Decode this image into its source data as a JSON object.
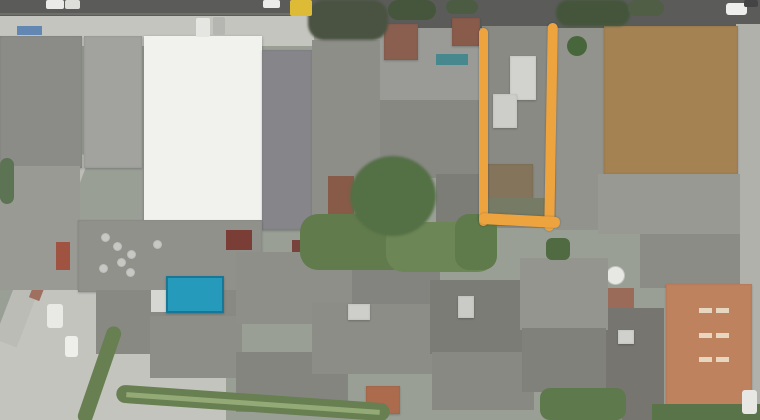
{
  "image": {
    "width": 760,
    "height": 420
  },
  "annotation": {
    "shape": "open-rectangle-outline",
    "color": "#f3a437"
  },
  "scene": {
    "base_color": "#9aa096",
    "palette": {
      "road": "#5a5b58",
      "concrete": "#c6c6c1",
      "roof_grey": "#8e8e89",
      "warehouse_white": "#f3f3f0",
      "dirt_lot": "#a7824e",
      "terracotta": "#c4815a",
      "pool_blue": "#1e9cc0",
      "vegetation": "#5f7b49",
      "annotation_orange": "#f3a437"
    },
    "elements": [
      {
        "name": "road-top",
        "x": 0,
        "y": 0,
        "w": 760,
        "h": 30,
        "color": "#5a5b58"
      },
      {
        "name": "road-lane-line",
        "x": 0,
        "y": 13,
        "w": 310,
        "h": 2,
        "color": "#6e6e6a"
      },
      {
        "name": "sidewalk-top-left",
        "x": 0,
        "y": 16,
        "w": 314,
        "h": 30,
        "color": "#c6c6c1",
        "cls": "mottle"
      },
      {
        "name": "street-right-edge",
        "x": 736,
        "y": 24,
        "w": 24,
        "h": 396,
        "color": "#b2b2ac",
        "cls": "mottle"
      },
      {
        "name": "plaza-bottom-left",
        "x": 0,
        "y": 284,
        "w": 226,
        "h": 136,
        "color": "#c5c5c0",
        "cls": "mottle",
        "clip": "polygon(14% 0,48% 0,100% 62%,100% 100%,0 100%,0 32%)"
      },
      {
        "name": "street-diagonal-left",
        "x": 30,
        "y": 146,
        "w": 24,
        "h": 204,
        "color": "#bdbdb7",
        "rz": 21
      },
      {
        "name": "brick-path-diagonal",
        "x": 44,
        "y": 216,
        "w": 11,
        "h": 86,
        "color": "#a26e5e",
        "rz": 21
      },
      {
        "name": "building-block-left",
        "x": 0,
        "y": 36,
        "w": 82,
        "h": 132,
        "color": "#8b8b87",
        "cls": "mottle b"
      },
      {
        "name": "building-block-left-lower",
        "x": 0,
        "y": 166,
        "w": 80,
        "h": 124,
        "color": "#9b9b95",
        "cls": "mottle"
      },
      {
        "name": "red-patch-left",
        "x": 56,
        "y": 242,
        "w": 14,
        "h": 28,
        "color": "#a5513c"
      },
      {
        "name": "ribbed-factory-roof",
        "x": 84,
        "y": 36,
        "w": 58,
        "h": 132,
        "color": "#a3a39f",
        "cls": "ribs b"
      },
      {
        "name": "white-warehouse-roof",
        "x": 144,
        "y": 36,
        "w": 118,
        "h": 186,
        "color": "#f3f3f0",
        "cls": "seam"
      },
      {
        "name": "building-block-b",
        "x": 262,
        "y": 50,
        "w": 50,
        "h": 180,
        "color": "#85858a",
        "cls": "mottle b"
      },
      {
        "name": "building-block-c",
        "x": 312,
        "y": 40,
        "w": 68,
        "h": 192,
        "color": "#8e8e89",
        "cls": "mottle"
      },
      {
        "name": "building-block-d",
        "x": 380,
        "y": 28,
        "w": 102,
        "h": 74,
        "color": "#9b9b96",
        "cls": "mottle"
      },
      {
        "name": "building-block-d2",
        "x": 380,
        "y": 100,
        "w": 102,
        "h": 78,
        "color": "#888883",
        "cls": "mottle"
      },
      {
        "name": "building-block-d3",
        "x": 436,
        "y": 174,
        "w": 46,
        "h": 58,
        "color": "#7d7d78",
        "cls": "mottle"
      },
      {
        "name": "brown-roof-a",
        "x": 384,
        "y": 24,
        "w": 34,
        "h": 36,
        "color": "#8c5e4e",
        "cls": "b"
      },
      {
        "name": "brown-roof-b",
        "x": 452,
        "y": 18,
        "w": 28,
        "h": 28,
        "color": "#8c5a48",
        "cls": "b"
      },
      {
        "name": "teal-roof-strip",
        "x": 436,
        "y": 54,
        "w": 32,
        "h": 11,
        "color": "#41898f"
      },
      {
        "name": "rust-roof-mid",
        "x": 328,
        "y": 176,
        "w": 26,
        "h": 48,
        "color": "#8a5a44"
      },
      {
        "name": "marked-lot-ground",
        "x": 482,
        "y": 26,
        "w": 74,
        "h": 202,
        "color": "#8a8a84",
        "cls": "mottle"
      },
      {
        "name": "marked-lot-building-a",
        "x": 510,
        "y": 56,
        "w": 26,
        "h": 44,
        "color": "#d4d4d0",
        "cls": "b"
      },
      {
        "name": "marked-lot-building-b",
        "x": 493,
        "y": 94,
        "w": 24,
        "h": 34,
        "color": "#cfcfcb",
        "cls": "b"
      },
      {
        "name": "marked-lot-shed",
        "x": 487,
        "y": 164,
        "w": 46,
        "h": 42,
        "color": "#85745a",
        "cls": "b"
      },
      {
        "name": "marked-lot-yard",
        "x": 484,
        "y": 198,
        "w": 70,
        "h": 28,
        "color": "#767b63",
        "cls": "leaf"
      },
      {
        "name": "building-block-e",
        "x": 556,
        "y": 28,
        "w": 50,
        "h": 202,
        "color": "#93938d",
        "cls": "mottle"
      },
      {
        "name": "round-bush",
        "x": 567,
        "y": 36,
        "w": 20,
        "h": 20,
        "color": "#466637",
        "r": "50%",
        "cls": "leaf"
      },
      {
        "name": "dirt-lot",
        "x": 604,
        "y": 26,
        "w": 134,
        "h": 148,
        "color": "#a7824e",
        "cls": "dirtm b"
      },
      {
        "name": "building-block-f",
        "x": 598,
        "y": 174,
        "w": 142,
        "h": 60,
        "color": "#9a9a94",
        "cls": "mottle"
      },
      {
        "name": "building-block-f2",
        "x": 640,
        "y": 234,
        "w": 100,
        "h": 54,
        "color": "#8c8c86",
        "cls": "mottle"
      },
      {
        "name": "brick-patch-right",
        "x": 604,
        "y": 288,
        "w": 30,
        "h": 24,
        "color": "#9c6a55"
      },
      {
        "name": "building-block-g",
        "x": 598,
        "y": 308,
        "w": 66,
        "h": 112,
        "color": "#76756e",
        "cls": "speck"
      },
      {
        "name": "terracotta-roof",
        "x": 666,
        "y": 284,
        "w": 86,
        "h": 126,
        "color": "#c4815a",
        "cls": "tile b"
      },
      {
        "name": "water-tank",
        "x": 607,
        "y": 267,
        "w": 17,
        "h": 17,
        "color": "#e9e9e5",
        "r": "50%",
        "cls": "vent"
      },
      {
        "name": "roof-mid-left",
        "x": 78,
        "y": 220,
        "w": 184,
        "h": 72,
        "color": "#91918b",
        "cls": "corrug b"
      },
      {
        "name": "roof-vent",
        "x": 102,
        "y": 234,
        "w": 7,
        "h": 7,
        "color": "#c8c8c4",
        "r": "50%",
        "cls": "vent"
      },
      {
        "name": "roof-vent",
        "x": 114,
        "y": 243,
        "w": 7,
        "h": 7,
        "color": "#c8c8c4",
        "r": "50%",
        "cls": "vent"
      },
      {
        "name": "roof-vent",
        "x": 118,
        "y": 259,
        "w": 7,
        "h": 7,
        "color": "#c8c8c4",
        "r": "50%",
        "cls": "vent"
      },
      {
        "name": "roof-vent",
        "x": 100,
        "y": 265,
        "w": 7,
        "h": 7,
        "color": "#c8c8c4",
        "r": "50%",
        "cls": "vent"
      },
      {
        "name": "roof-vent",
        "x": 128,
        "y": 251,
        "w": 7,
        "h": 7,
        "color": "#c8c8c4",
        "r": "50%",
        "cls": "vent"
      },
      {
        "name": "roof-vent",
        "x": 154,
        "y": 241,
        "w": 7,
        "h": 7,
        "color": "#c8c8c4",
        "r": "50%",
        "cls": "vent"
      },
      {
        "name": "roof-vent",
        "x": 127,
        "y": 269,
        "w": 7,
        "h": 7,
        "color": "#c8c8c4",
        "r": "50%",
        "cls": "vent"
      },
      {
        "name": "red-roof-bit-a",
        "x": 226,
        "y": 230,
        "w": 26,
        "h": 20,
        "color": "#7d3c33"
      },
      {
        "name": "red-roof-bit-b",
        "x": 292,
        "y": 240,
        "w": 18,
        "h": 20,
        "color": "#79413a"
      },
      {
        "name": "roof-tile-1",
        "x": 96,
        "y": 290,
        "w": 142,
        "h": 64,
        "color": "#898983",
        "cls": "corrugv"
      },
      {
        "name": "roof-tile-2",
        "x": 150,
        "y": 316,
        "w": 92,
        "h": 62,
        "color": "#8e8e88",
        "cls": "corrug"
      },
      {
        "name": "roof-tile-3",
        "x": 236,
        "y": 252,
        "w": 118,
        "h": 72,
        "color": "#8f8f89",
        "cls": "corrugv"
      },
      {
        "name": "roof-tile-4",
        "x": 236,
        "y": 352,
        "w": 112,
        "h": 60,
        "color": "#858580",
        "cls": "corrug"
      },
      {
        "name": "roof-tile-5",
        "x": 312,
        "y": 302,
        "w": 122,
        "h": 72,
        "color": "#8d8d87",
        "cls": "corrugv"
      },
      {
        "name": "roof-tile-6",
        "x": 352,
        "y": 238,
        "w": 88,
        "h": 66,
        "color": "#838380",
        "cls": "corrug"
      },
      {
        "name": "roof-tile-7",
        "x": 430,
        "y": 280,
        "w": 92,
        "h": 74,
        "color": "#7c7c76",
        "cls": "corrugv"
      },
      {
        "name": "roof-tile-8",
        "x": 432,
        "y": 352,
        "w": 102,
        "h": 58,
        "color": "#898984",
        "cls": "corrug"
      },
      {
        "name": "roof-tile-9",
        "x": 520,
        "y": 258,
        "w": 88,
        "h": 72,
        "color": "#95958f",
        "cls": "corrugv"
      },
      {
        "name": "roof-tile-10",
        "x": 522,
        "y": 328,
        "w": 84,
        "h": 64,
        "color": "#81817b",
        "cls": "corrug"
      },
      {
        "name": "roof-tile-11",
        "x": 560,
        "y": 392,
        "w": 62,
        "h": 28,
        "color": "#8a8a85"
      },
      {
        "name": "white-roof-bit-a",
        "x": 348,
        "y": 304,
        "w": 22,
        "h": 16,
        "color": "#d0d0cc",
        "cls": "b"
      },
      {
        "name": "white-roof-bit-b",
        "x": 458,
        "y": 296,
        "w": 16,
        "h": 22,
        "color": "#ccccc8",
        "cls": "b"
      },
      {
        "name": "white-roof-bit-c",
        "x": 618,
        "y": 330,
        "w": 16,
        "h": 14,
        "color": "#d2d2ce",
        "cls": "b"
      },
      {
        "name": "rust-roof-bottom",
        "x": 366,
        "y": 386,
        "w": 34,
        "h": 28,
        "color": "#b06a49",
        "cls": "b"
      },
      {
        "name": "pool-deck",
        "x": 151,
        "y": 290,
        "w": 16,
        "h": 22,
        "color": "#d8d8d4"
      },
      {
        "name": "swimming-pool",
        "x": 166,
        "y": 276,
        "w": 58,
        "h": 37,
        "color": "#1e9cc0",
        "cls": "pool"
      },
      {
        "name": "garden-patch-a",
        "x": 300,
        "y": 214,
        "w": 110,
        "h": 56,
        "color": "#5f7b49",
        "r": 18,
        "cls": "leaf"
      },
      {
        "name": "garden-patch-b",
        "x": 386,
        "y": 222,
        "w": 110,
        "h": 50,
        "color": "#6a8753",
        "r": 18,
        "cls": "leaf"
      },
      {
        "name": "large-tree",
        "x": 350,
        "y": 156,
        "w": 86,
        "h": 80,
        "color": "#527042",
        "r": "50%",
        "cls": "leaf soft"
      },
      {
        "name": "garden-patch-c",
        "x": 455,
        "y": 214,
        "w": 42,
        "h": 56,
        "color": "#5d7a48",
        "r": 14,
        "cls": "leaf"
      },
      {
        "name": "tree-canopy-a",
        "x": 308,
        "y": 0,
        "w": 80,
        "h": 40,
        "color": "#49523f",
        "r": 16,
        "cls": "leaf soft"
      },
      {
        "name": "tree-canopy-b",
        "x": 388,
        "y": 0,
        "w": 48,
        "h": 20,
        "color": "#44553a",
        "r": 12,
        "cls": "leaf"
      },
      {
        "name": "tree-canopy-c",
        "x": 446,
        "y": 0,
        "w": 32,
        "h": 14,
        "color": "#4a5c40",
        "r": 10,
        "cls": "leaf"
      },
      {
        "name": "tree-canopy-d",
        "x": 556,
        "y": 0,
        "w": 74,
        "h": 26,
        "color": "#425538",
        "r": 12,
        "cls": "leaf soft"
      },
      {
        "name": "tree-canopy-e",
        "x": 628,
        "y": 0,
        "w": 36,
        "h": 16,
        "color": "#4d5e42",
        "r": 10,
        "cls": "leaf"
      },
      {
        "name": "tree-left-edge",
        "x": 0,
        "y": 158,
        "w": 14,
        "h": 46,
        "color": "#5a7450",
        "r": 8,
        "cls": "leaf"
      },
      {
        "name": "small-green-yard",
        "x": 546,
        "y": 238,
        "w": 24,
        "h": 22,
        "color": "#4e6a3e",
        "r": 6,
        "cls": "leaf"
      },
      {
        "name": "grass-verge-steep",
        "x": 92,
        "y": 324,
        "w": 15,
        "h": 102,
        "color": "#65804e",
        "rz": 19,
        "r": 8
      },
      {
        "name": "grass-verge-shallow",
        "x": 116,
        "y": 394,
        "w": 274,
        "h": 18,
        "color": "#65804e",
        "rz": 4,
        "r": 9
      },
      {
        "name": "verge-footpath",
        "x": 126,
        "y": 401,
        "w": 254,
        "h": 5,
        "color": "#93ab74",
        "rz": 4
      },
      {
        "name": "green-patch-a",
        "x": 540,
        "y": 388,
        "w": 86,
        "h": 32,
        "color": "#5c7948",
        "r": 10,
        "cls": "leaf"
      },
      {
        "name": "green-patch-b",
        "x": 652,
        "y": 404,
        "w": 108,
        "h": 16,
        "color": "#577446",
        "cls": "leaf"
      },
      {
        "name": "blue-awning",
        "x": 17,
        "y": 26,
        "w": 25,
        "h": 9,
        "color": "#5e88b6"
      },
      {
        "name": "car-on-road-a",
        "x": 46,
        "y": 0,
        "w": 18,
        "h": 9,
        "color": "#ececea",
        "r": 2
      },
      {
        "name": "car-on-road-b",
        "x": 65,
        "y": 0,
        "w": 15,
        "h": 9,
        "color": "#e0e0dd",
        "r": 2
      },
      {
        "name": "car-on-road-c",
        "x": 263,
        "y": 0,
        "w": 17,
        "h": 8,
        "color": "#eeeeec",
        "r": 2
      },
      {
        "name": "yellow-truck",
        "x": 290,
        "y": 0,
        "w": 22,
        "h": 16,
        "color": "#e2bc2d",
        "r": 2
      },
      {
        "name": "car-on-road-d",
        "x": 726,
        "y": 3,
        "w": 21,
        "h": 12,
        "color": "#f0f0ee",
        "r": 3
      },
      {
        "name": "car-on-road-e",
        "x": 744,
        "y": 0,
        "w": 14,
        "h": 7,
        "color": "#434343",
        "r": 2
      },
      {
        "name": "car-parked-a",
        "x": 196,
        "y": 18,
        "w": 14,
        "h": 19,
        "color": "#e7e7e4",
        "r": 2
      },
      {
        "name": "car-parked-b",
        "x": 213,
        "y": 17,
        "w": 12,
        "h": 18,
        "color": "#b6b6b3",
        "r": 2
      },
      {
        "name": "car-plaza-a",
        "x": 47,
        "y": 304,
        "w": 16,
        "h": 24,
        "color": "#ebebe8",
        "r": 3
      },
      {
        "name": "car-plaza-b",
        "x": 65,
        "y": 336,
        "w": 13,
        "h": 21,
        "color": "#f0f0ed",
        "r": 3
      },
      {
        "name": "car-street-right",
        "x": 742,
        "y": 390,
        "w": 15,
        "h": 24,
        "color": "#e9e9e6",
        "r": 3
      },
      {
        "name": "terracotta-skylight",
        "x": 699,
        "y": 308,
        "w": 13,
        "h": 5,
        "color": "#ead8c0"
      },
      {
        "name": "terracotta-skylight",
        "x": 716,
        "y": 308,
        "w": 13,
        "h": 5,
        "color": "#ead8c0"
      },
      {
        "name": "terracotta-skylight",
        "x": 699,
        "y": 333,
        "w": 13,
        "h": 5,
        "color": "#ead8c0"
      },
      {
        "name": "terracotta-skylight",
        "x": 716,
        "y": 333,
        "w": 13,
        "h": 5,
        "color": "#ead8c0"
      },
      {
        "name": "terracotta-skylight",
        "x": 699,
        "y": 357,
        "w": 13,
        "h": 5,
        "color": "#ead8c0"
      },
      {
        "name": "terracotta-skylight",
        "x": 716,
        "y": 357,
        "w": 13,
        "h": 5,
        "color": "#ead8c0"
      },
      {
        "name": "annotation-left-line",
        "x": 479,
        "y": 28,
        "w": 9,
        "h": 198,
        "color": "#f3a437",
        "r": 5,
        "cls": "ann"
      },
      {
        "name": "annotation-right-line",
        "x": 546,
        "y": 23,
        "w": 10,
        "h": 208,
        "color": "#f3a437",
        "r": 5,
        "rz": 1,
        "cls": "ann"
      },
      {
        "name": "annotation-bottom-line",
        "x": 479,
        "y": 215,
        "w": 81,
        "h": 11,
        "color": "#f3a437",
        "r": 5,
        "rz": 3,
        "cls": "ann"
      }
    ]
  }
}
